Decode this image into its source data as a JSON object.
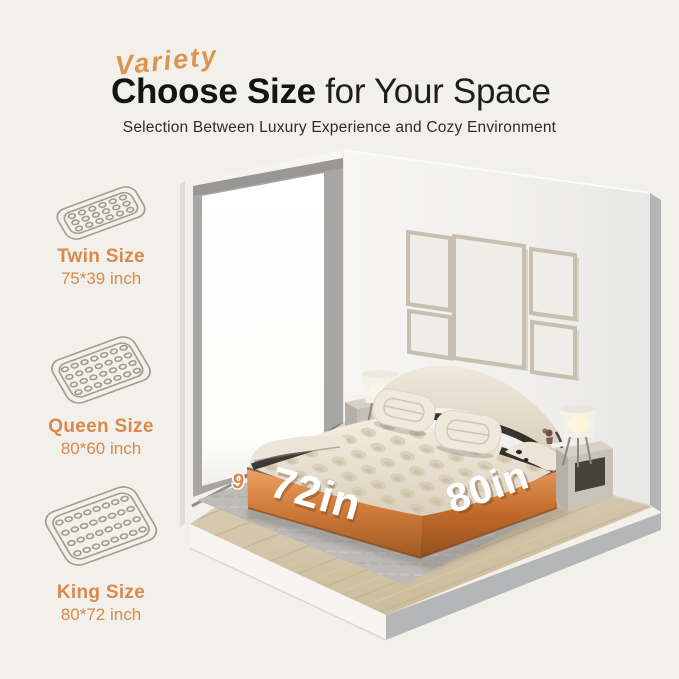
{
  "header": {
    "eyebrow": "Variety",
    "title_strong": "Choose Size",
    "title_light": " for Your Space",
    "subtitle": "Selection Between Luxury Experience and Cozy Environment"
  },
  "sizes": [
    {
      "name": "Twin Size",
      "dims": "75*39 inch"
    },
    {
      "name": "Queen Size",
      "dims": "80*60 inch"
    },
    {
      "name": "King Size",
      "dims": "80*72 inch"
    }
  ],
  "scene": {
    "width_label": "72in",
    "length_label": "80in",
    "height_label_partial": "9"
  },
  "colors": {
    "background": "#F2F0EA",
    "accent_orange": "#D8894B",
    "script_orange": "#DD944F",
    "copper_band": "#C06A2A",
    "title_text": "#141414"
  }
}
